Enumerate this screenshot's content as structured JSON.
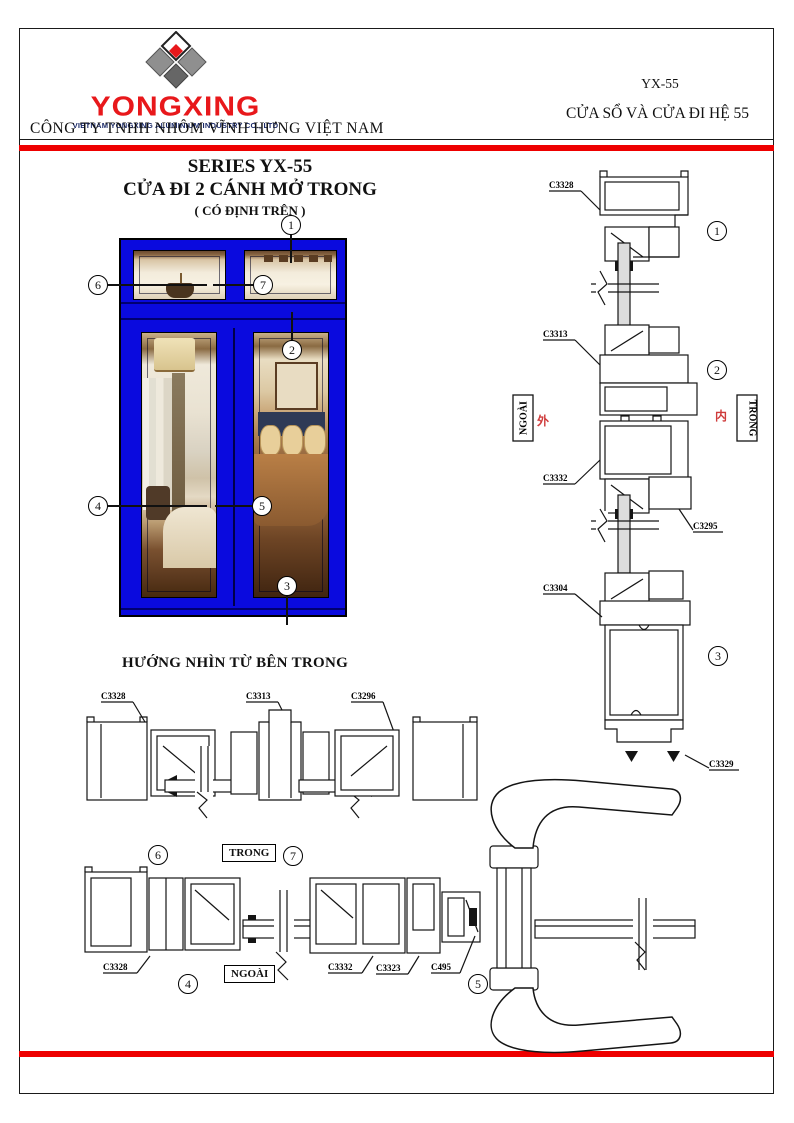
{
  "header": {
    "logo_text": "YONGXING",
    "logo_tagline": "VIETNAM YONGXING ALUMINIUM INDUSTRY CO., LTD",
    "company_name": "CÔNG TY TNHH NHÔM VĨNH HƯNG VIỆT NAM",
    "doc_code": "YX-55",
    "doc_title": "CỬA SỔ VÀ CỬA ĐI HỆ 55"
  },
  "title_block": {
    "line1": "SERIES YX-55",
    "line2": "CỬA ĐI 2 CÁNH MỞ TRONG",
    "line3": "( CÓ ĐỊNH TRÊN )"
  },
  "section_heading": "HƯỚNG NHÌN TỪ BÊN TRONG",
  "orientation": {
    "outside": "NGOÀI",
    "inside": "TRONG",
    "outside_cn": "外",
    "inside_cn": "内"
  },
  "callouts": {
    "c1": "1",
    "c2": "2",
    "c3": "3",
    "c4": "4",
    "c5": "5",
    "c6": "6",
    "c7": "7"
  },
  "vertical_section": {
    "p1": "C3328",
    "p2": "C3313",
    "p3": "C3332",
    "p4": "C3295",
    "p5": "C3304",
    "p6": "C3329"
  },
  "plan_top": {
    "p1": "C3328",
    "p2": "C3313",
    "p3": "C3296"
  },
  "plan_bottom": {
    "p1": "C3328",
    "p2": "C3332",
    "p3": "C3323",
    "p4": "C495"
  },
  "colors": {
    "accent_red": "#ee0000",
    "frame_blue": "#0a0ade",
    "logo_red": "#e8181b",
    "logo_navy": "#1b2a68",
    "cn_red": "#cf3b3b"
  }
}
